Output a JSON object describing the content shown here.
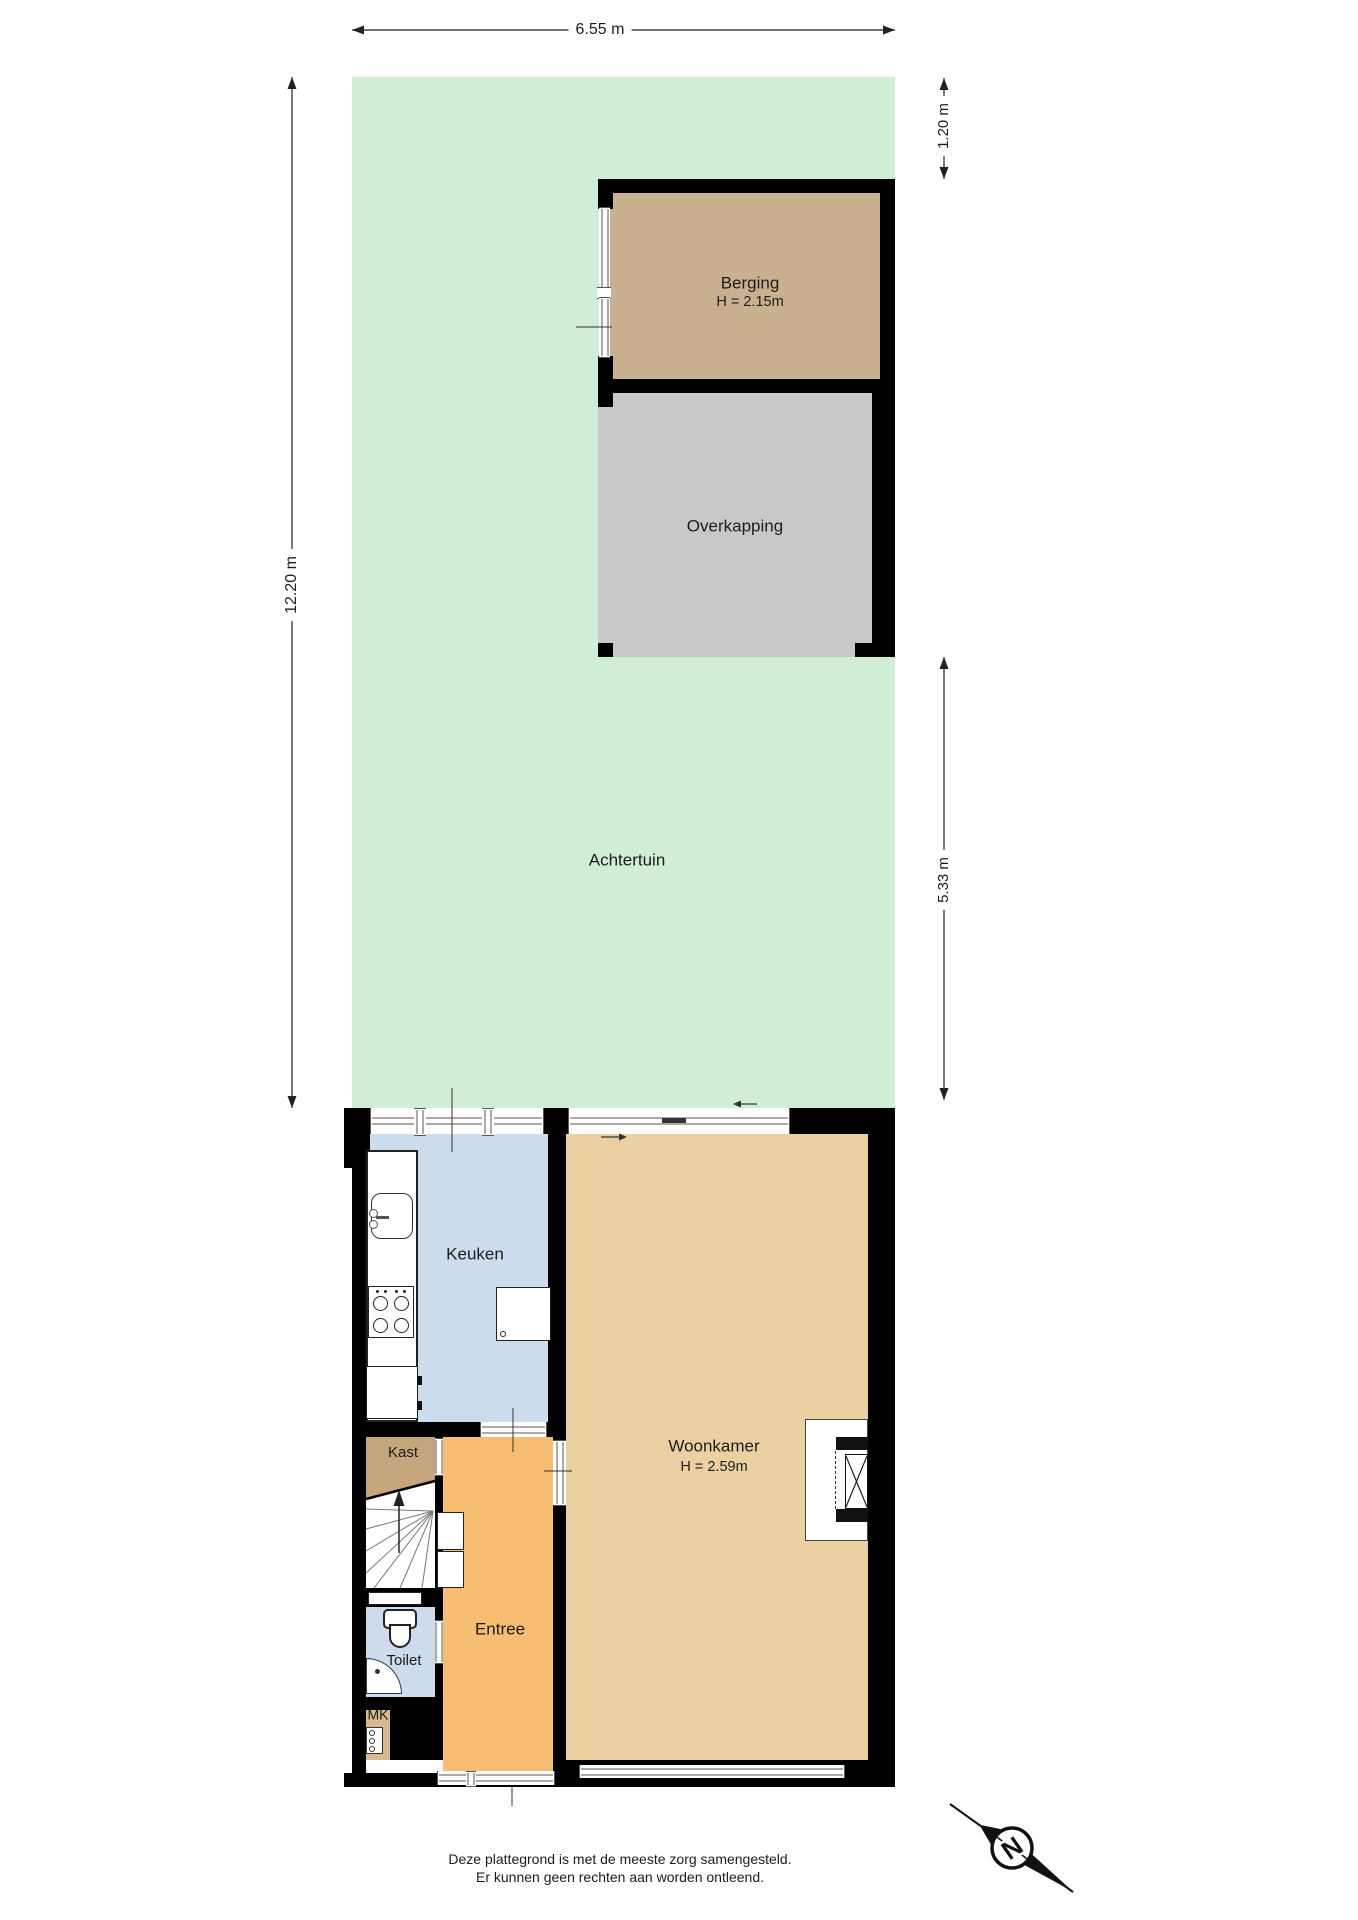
{
  "plan": {
    "rooms": {
      "achtertuin": {
        "label": "Achtertuin"
      },
      "berging": {
        "label": "Berging",
        "height_label": "H = 2.15m"
      },
      "overkapping": {
        "label": "Overkapping"
      },
      "keuken": {
        "label": "Keuken"
      },
      "woonkamer": {
        "label": "Woonkamer",
        "height_label": "H = 2.59m"
      },
      "kast": {
        "label": "Kast"
      },
      "entree": {
        "label": "Entree"
      },
      "toilet": {
        "label": "Toilet"
      },
      "mk": {
        "label": "MK"
      }
    },
    "dimensions": {
      "top": "6.55 m",
      "left": "12.20 m",
      "right_upper": "1.20 m",
      "right_lower": "5.33 m"
    },
    "compass": {
      "letter": "N"
    },
    "footer": {
      "line1": "Deze plattegrond is met de meeste zorg samengesteld.",
      "line2": "Er kunnen geen rechten aan worden ontleend."
    },
    "colors": {
      "wall": "#000000",
      "garden": "#d0edd6",
      "berging": "#c9b08f",
      "overkapping": "#c8c8c8",
      "keuken": "#cddcec",
      "woonkamer": "#ebd1a2",
      "entree": "#f7bd72",
      "kast": "#c5a67c",
      "toilet": "#cddcec",
      "mk": "#d8ba8e"
    }
  }
}
